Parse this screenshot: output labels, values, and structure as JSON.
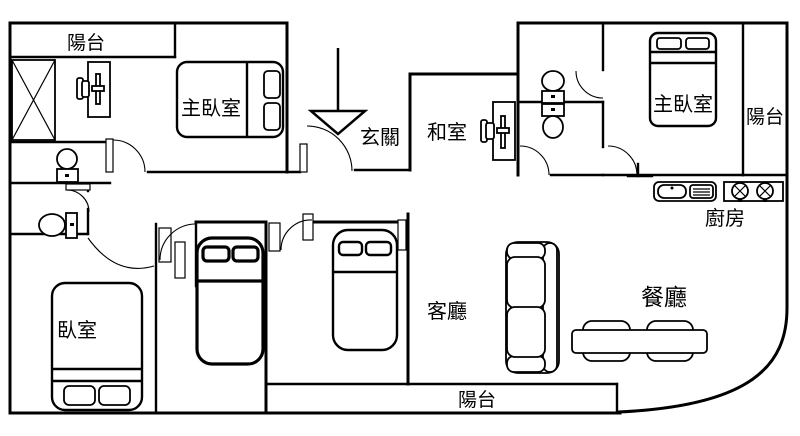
{
  "floorplan": {
    "type": "apartment-floor-plan",
    "background_color": "#ffffff",
    "line_color": "#000000",
    "rooms": {
      "balcony_top_left": {
        "label": "陽台"
      },
      "master_bedroom_left": {
        "label": "主臥室"
      },
      "entry": {
        "label": "玄關"
      },
      "tatami_room": {
        "label": "和室"
      },
      "master_bedroom_right": {
        "label": "主臥室"
      },
      "balcony_right": {
        "label": "陽台"
      },
      "kitchen": {
        "label": "廚房"
      },
      "living_room": {
        "label": "客廳"
      },
      "dining_room": {
        "label": "餐廳"
      },
      "bedroom": {
        "label": "臥室"
      },
      "balcony_bottom": {
        "label": "陽台"
      }
    }
  }
}
